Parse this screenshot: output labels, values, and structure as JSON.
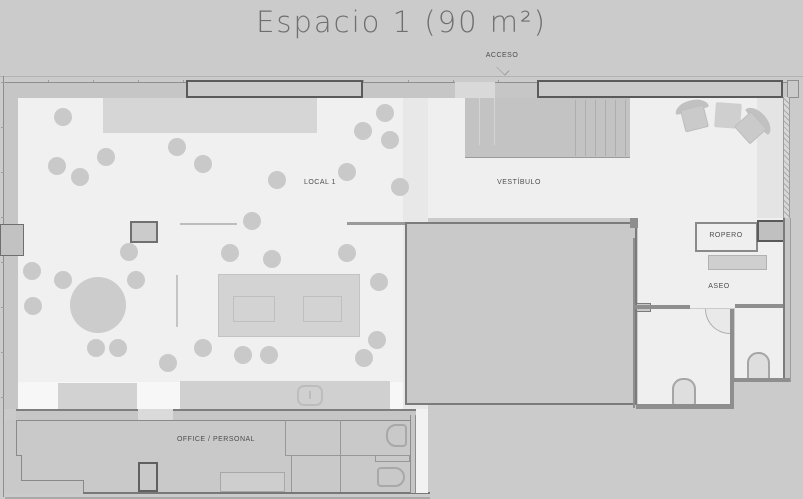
{
  "title": "Espacio 1 (90 m²)",
  "labels": {
    "acceso": "ACCESO",
    "local_1": "LOCAL 1",
    "vestibulo": "VESTÍBULO",
    "ropero": "ROPERO",
    "aseo": "ASEO",
    "office_personal": "OFFICE / PERSONAL"
  },
  "colors": {
    "background": "#cbcbcb",
    "floor": "#f0f0f0",
    "floor_vestibule": "#efefef",
    "zone_shaded": "#d6d6d6",
    "strip": "#e8e8e8",
    "wall_band": "#c6c6c6",
    "wall_line": "#7b7b7b",
    "facade_outline": "#5a5a5a",
    "furniture": "#c9c9c9",
    "title_text": "#6f6f6f",
    "label_text": "#4d4d4d"
  },
  "plan": {
    "seats": [
      [
        63,
        117
      ],
      [
        57,
        166
      ],
      [
        80,
        177
      ],
      [
        106,
        157
      ],
      [
        177,
        147
      ],
      [
        203,
        164
      ],
      [
        252,
        221
      ],
      [
        277,
        180
      ],
      [
        347,
        172
      ],
      [
        363,
        131
      ],
      [
        385,
        113
      ],
      [
        390,
        140
      ],
      [
        400,
        187
      ],
      [
        32,
        271
      ],
      [
        63,
        280
      ],
      [
        33,
        306
      ],
      [
        129,
        252
      ],
      [
        136,
        280
      ],
      [
        96,
        348
      ],
      [
        118,
        348
      ],
      [
        168,
        363
      ],
      [
        230,
        253
      ],
      [
        272,
        259
      ],
      [
        347,
        253
      ],
      [
        379,
        282
      ],
      [
        377,
        340
      ],
      [
        364,
        358
      ],
      [
        243,
        355
      ],
      [
        269,
        355
      ],
      [
        203,
        348
      ]
    ]
  }
}
